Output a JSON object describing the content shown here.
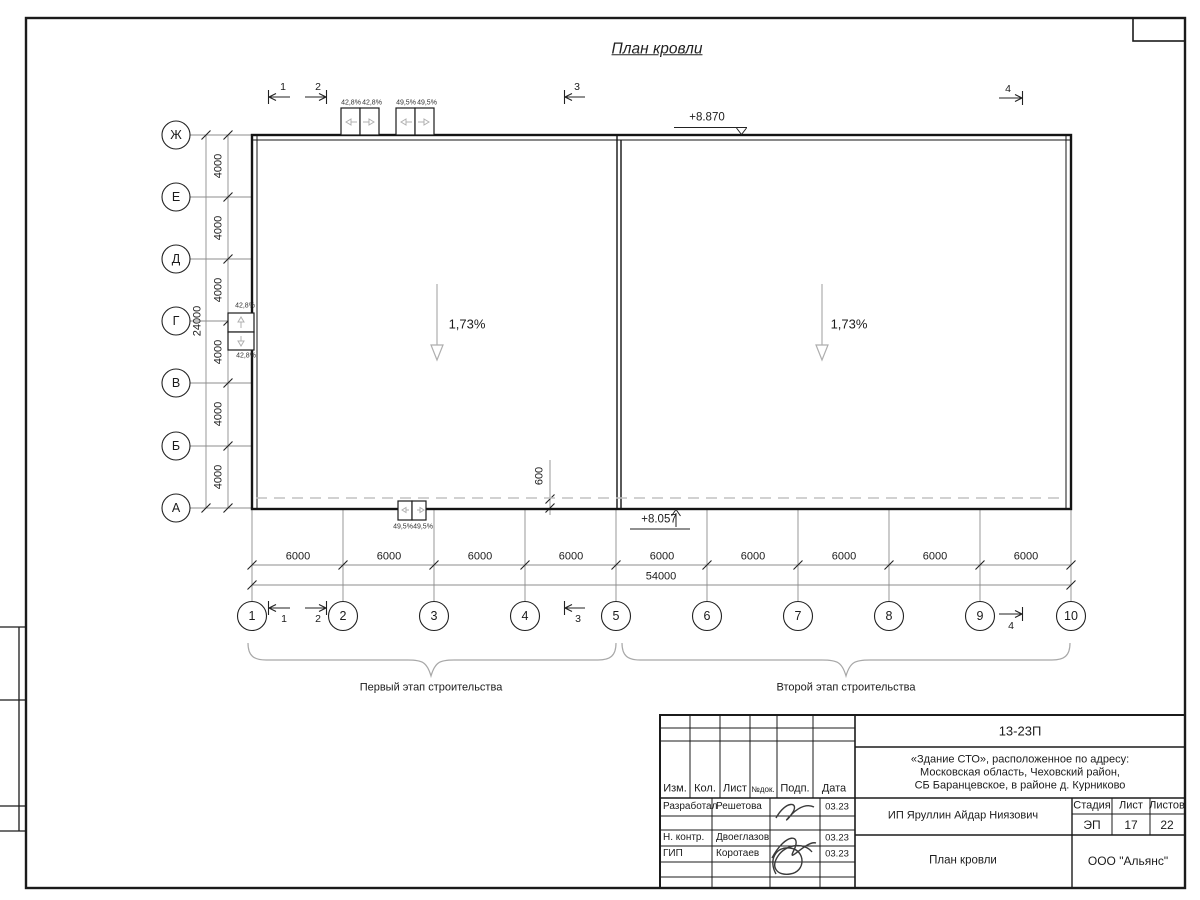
{
  "sheet": {
    "title": "План кровли"
  },
  "plan": {
    "elevation_top": "+8.870",
    "elevation_bottom": "+8.057",
    "slope_left": "1,73%",
    "slope_right": "1,73%",
    "dim_600": "600",
    "row_axes": [
      "Ж",
      "Е",
      "Д",
      "Г",
      "В",
      "Б",
      "А"
    ],
    "col_axes": [
      "1",
      "2",
      "3",
      "4",
      "5",
      "6",
      "7",
      "8",
      "9",
      "10"
    ],
    "row_dim": "4000",
    "row_total": "24000",
    "col_dim": "6000",
    "col_total": "54000",
    "section_marks": [
      "1",
      "2",
      "3",
      "4"
    ],
    "vent_top_a1": "42,8%",
    "vent_top_a2": "42,8%",
    "vent_top_b1": "49,5%",
    "vent_top_b2": "49,5%",
    "vent_side_top": "42,8%",
    "vent_side_bottom": "42,8%",
    "vent_bottom_1": "49,5%",
    "vent_bottom_2": "49,5%",
    "stage_first": "Первый этап строительства",
    "stage_second": "Второй этап строительства"
  },
  "titleblock": {
    "doc_number": "13-23П",
    "project_address_1": "«Здание СТО», расположенное по адресу:",
    "project_address_2": "Московская область, Чеховский район,",
    "project_address_3": "СБ Баранцевское, в районе д. Курниково",
    "header": [
      "Изм.",
      "Кол.",
      "Лист",
      "№док.",
      "Подп.",
      "Дата"
    ],
    "signature_rows": [
      {
        "role": "Разработал",
        "name": "Решетова",
        "date": "03.23"
      },
      {
        "role": "Н. контр.",
        "name": "Двоеглазов",
        "date": "03.23"
      },
      {
        "role": "ГИП",
        "name": "Коротаев",
        "date": "03.23"
      }
    ],
    "client": "ИП Яруллин Айдар Ниязович",
    "stage_label": "Стадия",
    "sheet_label": "Лист",
    "sheets_label": "Листов",
    "stage_value": "ЭП",
    "sheet_value": "17",
    "sheets_value": "22",
    "drawing_title": "План кровли",
    "company": "ООО \"Альянс\""
  },
  "colors": {
    "line": "#1b1b1b",
    "thin": "#8d8d8d",
    "light": "#b5b5b5"
  }
}
